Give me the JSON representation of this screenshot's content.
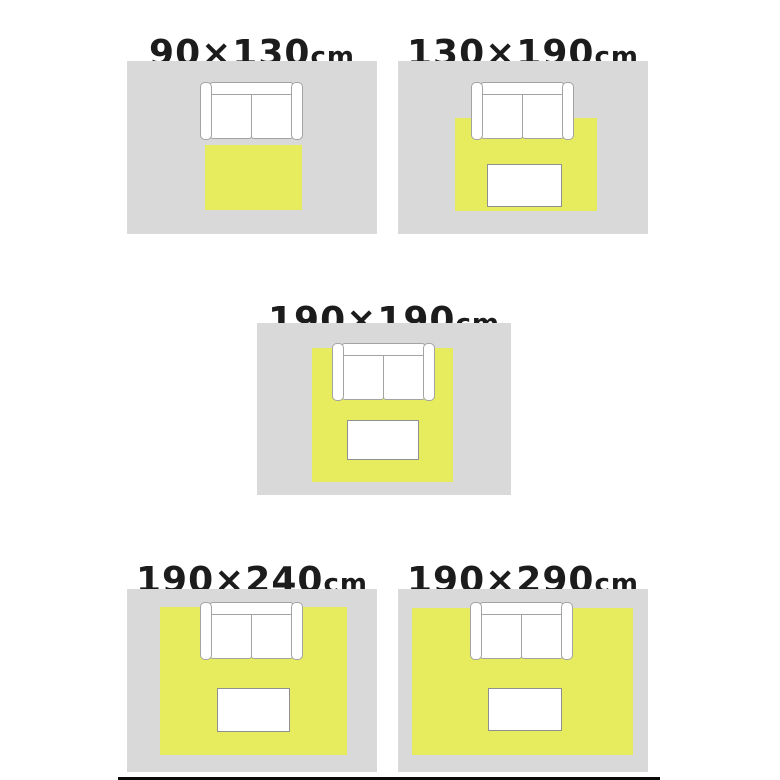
{
  "panels": [
    {
      "size": "90×130",
      "unit": "cm",
      "rug_cm": {
        "width": 90,
        "length": 130
      },
      "has_table": false
    },
    {
      "size": "130×190",
      "unit": "cm",
      "rug_cm": {
        "width": 130,
        "length": 190
      },
      "has_table": true
    },
    {
      "size": "190×190",
      "unit": "cm",
      "rug_cm": {
        "width": 190,
        "length": 190
      },
      "has_table": true
    },
    {
      "size": "190×240",
      "unit": "cm",
      "rug_cm": {
        "width": 190,
        "length": 240
      },
      "has_table": true
    },
    {
      "size": "190×290",
      "unit": "cm",
      "rug_cm": {
        "width": 190,
        "length": 290
      },
      "has_table": true
    }
  ],
  "colors": {
    "floor": "#d9d9d9",
    "rug": "#e7ec5e",
    "furniture-fill": "#ffffff",
    "outline": "#a3a3a3",
    "table-outline": "#8f8f8f",
    "text": "#1c1c1c",
    "bar": "#0a0a0a"
  }
}
